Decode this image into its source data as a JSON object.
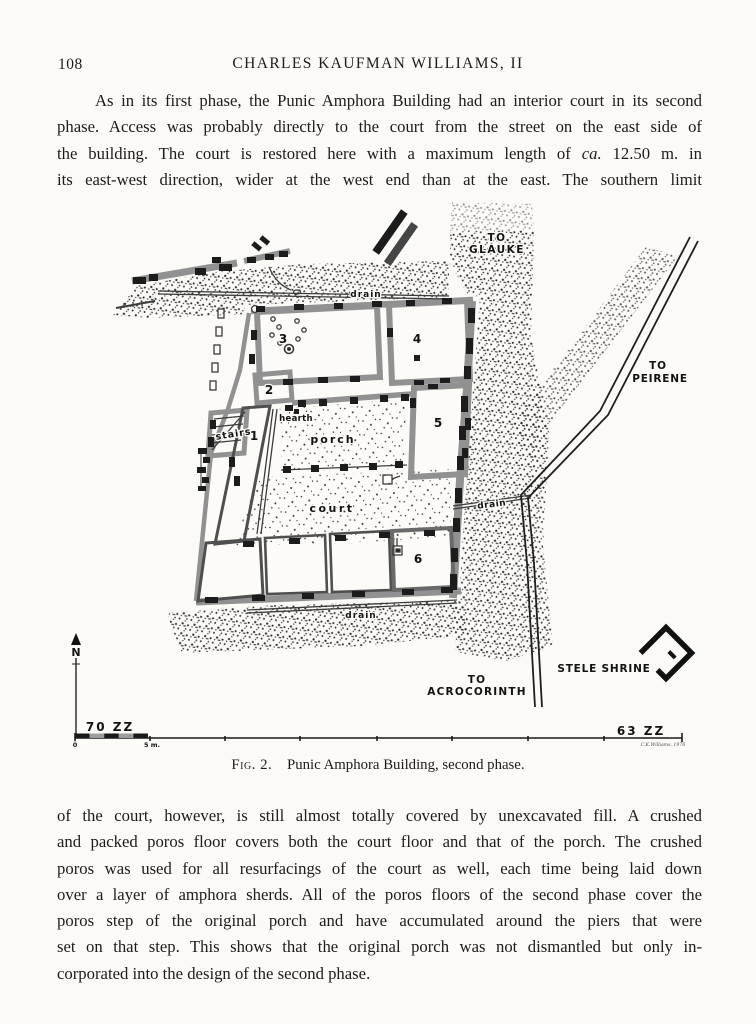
{
  "page": {
    "number": "108",
    "header": "CHARLES KAUFMAN WILLIAMS, II"
  },
  "para1": {
    "l1": "As in its first phase, the Punic Amphora Building had an interior court in its second",
    "l2": "phase. Access was probably directly to the court from the street on the east side of",
    "l3a": "the building. The court is restored here with a maximum length of ",
    "l3b": "ca.",
    "l3c": " 12.50 m. in",
    "l4": "its east-west direction, wider at the west end than at the east. The southern limit"
  },
  "para2": {
    "l1": "of the court, however, is still almost totally covered by unexcavated fill. A crushed",
    "l2": "and packed poros floor covers both the court floor and that of the porch. The crushed",
    "l3": "poros was used for all resurfacings of the court as well, each time being laid down",
    "l4": "over a layer of amphora sherds. All of the poros floors of the second phase cover the",
    "l5": "poros step of the original porch and have accumulated around the piers that were",
    "l6": "set on that step. This shows that the original porch was not dismantled but only in-",
    "l7": "corporated into the design of the second phase."
  },
  "figure": {
    "caption_fig": "Fig. 2.",
    "caption_text": "Punic Amphora Building, second phase.",
    "labels": {
      "to_glauke_1": "TO",
      "to_glauke_2": "GLAUKE",
      "to_peirene_1": "TO",
      "to_peirene_2": "PEIRENE",
      "to_acro_1": "TO",
      "to_acro_2": "ACROCORINTH",
      "stele_shrine": "STELE SHRINE",
      "drain_north": "drain",
      "drain_east": "drain",
      "drain_south": "drain",
      "court": "court",
      "porch": "porch",
      "hearth": "hearth",
      "stairs": "stairs",
      "room1": "1",
      "room2": "2",
      "room3": "3",
      "room4": "4",
      "room5": "5",
      "room6": "6",
      "north": "N",
      "elev_west": "70 ZZ",
      "elev_east": "63 ZZ",
      "scale_zero": "0",
      "scale_five": "5 m.",
      "signature": "C.K.Williams, 1978"
    },
    "colors": {
      "wall_gray": "#919191",
      "pier_black": "#1c1c1c",
      "stipple": "#2e2e2e"
    }
  }
}
